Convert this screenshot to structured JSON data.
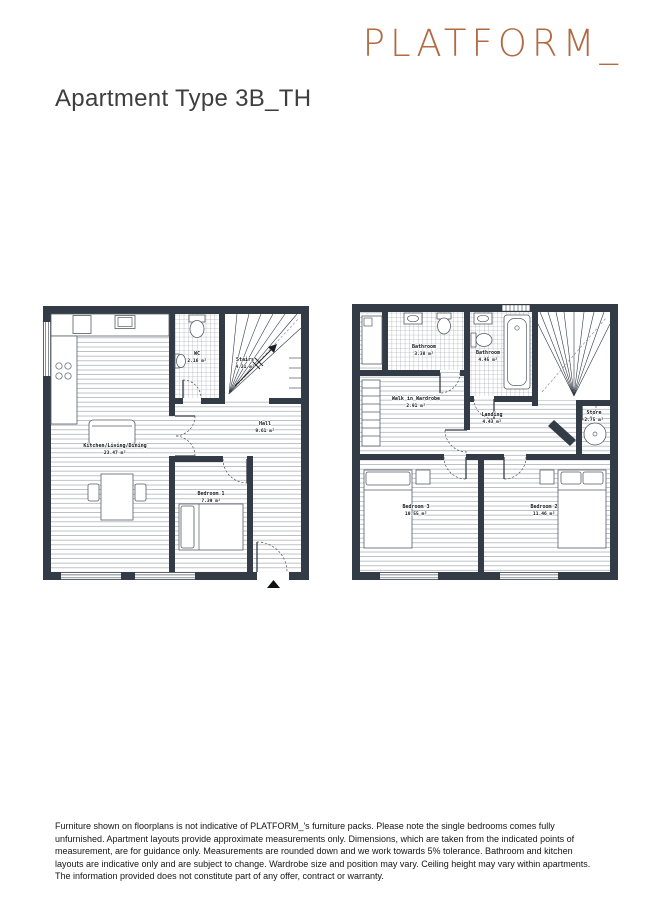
{
  "brand": {
    "logo": "PLATFORM_"
  },
  "page": {
    "title": "Apartment Type 3B_TH"
  },
  "colors": {
    "logo_copper": "#b16a41",
    "wall_dark": "#333b46",
    "title_text": "#3e3e3e"
  },
  "floorplans": [
    {
      "name": "ground-floor-plan",
      "rooms": [
        {
          "label": "Kitchen/Living/Dining",
          "area": "23.47 m²"
        },
        {
          "label": "WC",
          "area": "2.16 m²"
        },
        {
          "label": "Stairs",
          "area": "4.21 m²"
        },
        {
          "label": "Hall",
          "area": "9.61 m²"
        },
        {
          "label": "Bedroom 1",
          "area": "7.39 m²"
        }
      ]
    },
    {
      "name": "first-floor-plan",
      "rooms": [
        {
          "label": "Bathroom",
          "area": "3.38 m²"
        },
        {
          "label": "Bathroom",
          "area": "4.45 m²"
        },
        {
          "label": "Walk in Wardrobe",
          "area": "2.91 m²"
        },
        {
          "label": "Landing",
          "area": "4.43 m²"
        },
        {
          "label": "Store",
          "area": "2.75 m²"
        },
        {
          "label": "Bedroom 3",
          "area": "10.55 m²"
        },
        {
          "label": "Bedroom 2",
          "area": "11.46 m²"
        }
      ]
    }
  ],
  "disclaimer": "Furniture shown on floorplans is not indicative of PLATFORM_'s furniture packs. Please note the single bedrooms comes fully unfurnished. Apartment layouts provide approximate measurements only. Dimensions, which are taken from the indicated points of measurement, are for guidance only. Measurements are rounded down and we work towards 5% tolerance. Bathroom and kitchen layouts are indicative only and are subject to change. Wardrobe size and position may vary. Ceiling height may vary within apartments. The information provided does not constitute part of any offer, contract or warranty."
}
